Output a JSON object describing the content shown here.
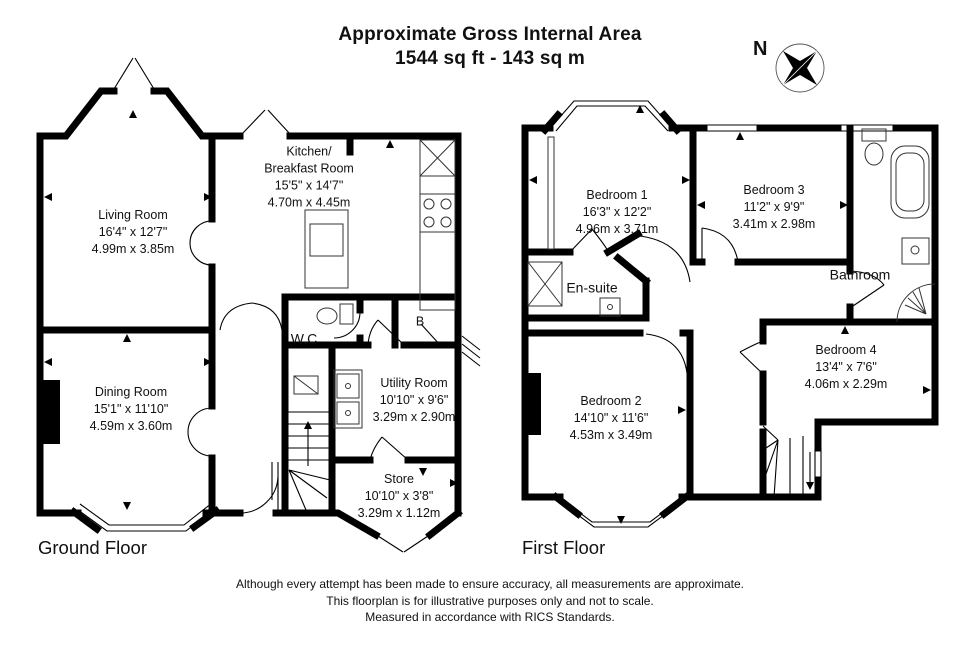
{
  "header": {
    "title": "Approximate Gross Internal Area",
    "subtitle": "1544 sq ft - 143 sq m"
  },
  "compass": {
    "label": "N"
  },
  "ground_floor": {
    "label": "Ground Floor",
    "rooms": [
      {
        "name": "Living Room",
        "imperial": "16'4\" x 12'7\"",
        "metric": "4.99m x 3.85m"
      },
      {
        "name": "Kitchen/\nBreakfast Room",
        "imperial": "15'5\" x 14'7\"",
        "metric": "4.70m x 4.45m"
      },
      {
        "name": "Dining Room",
        "imperial": "15'1\" x 11'10\"",
        "metric": "4.59m x 3.60m"
      },
      {
        "name": "W.C"
      },
      {
        "name": "B"
      },
      {
        "name": "Utility Room",
        "imperial": "10'10\" x 9'6\"",
        "metric": "3.29m x 2.90m"
      },
      {
        "name": "Store",
        "imperial": "10'10\" x 3'8\"",
        "metric": "3.29m x 1.12m"
      }
    ]
  },
  "first_floor": {
    "label": "First Floor",
    "rooms": [
      {
        "name": "Bedroom 1",
        "imperial": "16'3\" x 12'2\"",
        "metric": "4.96m x 3.71m"
      },
      {
        "name": "Bedroom 3",
        "imperial": "11'2\" x 9'9\"",
        "metric": "3.41m x 2.98m"
      },
      {
        "name": "En-suite"
      },
      {
        "name": "Bathroom"
      },
      {
        "name": "Bedroom 4",
        "imperial": "13'4\" x 7'6\"",
        "metric": "4.06m x 2.29m"
      },
      {
        "name": "Bedroom 2",
        "imperial": "14'10\" x 11'6\"",
        "metric": "4.53m x 3.49m"
      }
    ]
  },
  "footer": {
    "line1": "Although every attempt has been made to ensure accuracy, all measurements are approximate.",
    "line2": "This floorplan is for illustrative purposes only and not to scale.",
    "line3": "Measured in accordance with RICS Standards."
  }
}
